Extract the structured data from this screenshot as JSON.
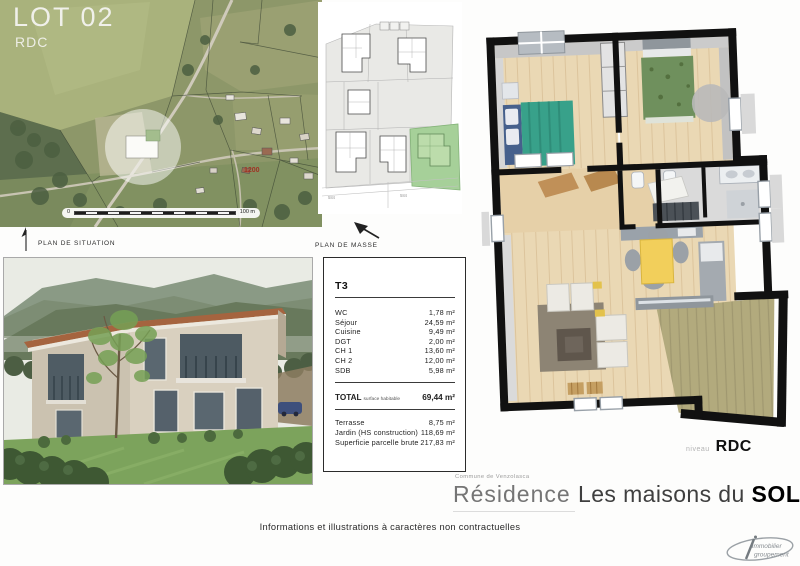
{
  "situation": {
    "lot_label": "LOT 02",
    "level_label": "RDC",
    "parcel_number": "1200",
    "scale_zero": "0",
    "scale_end": "100 m",
    "caption": "PLAN DE SITUATION"
  },
  "masse": {
    "caption": "PLAN DE MASSE",
    "dim_left": "584",
    "dim_right": "584"
  },
  "floorplan": {
    "niveau_label": "niveau",
    "level": "RDC"
  },
  "surface_table": {
    "type_label": "T3",
    "rooms": [
      {
        "label": "WC",
        "area": "1,78 m²"
      },
      {
        "label": "Séjour",
        "area": "24,59 m²"
      },
      {
        "label": "Cuisine",
        "area": "9,49 m²"
      },
      {
        "label": "DGT",
        "area": "2,00 m²"
      },
      {
        "label": "CH 1",
        "area": "13,60 m²"
      },
      {
        "label": "CH 2",
        "area": "12,00 m²"
      },
      {
        "label": "SDB",
        "area": "5,98 m²"
      }
    ],
    "total": {
      "label": "TOTAL",
      "sublabel": "surface habitable",
      "area": "69,44 m²"
    },
    "extras": [
      {
        "label": "Terrasse",
        "area": "8,75 m²"
      },
      {
        "label": "Jardin (HS construction)",
        "area": "118,69 m²"
      },
      {
        "label": "Superficie parcelle brute",
        "area": "217,83 m²"
      }
    ]
  },
  "captions": {
    "commune": "Commune de Venzolasca",
    "residence": "Résidence",
    "name_prefix": "Les maisons du ",
    "name_bold": "SOLEIL"
  },
  "footer": {
    "disclaimer": "Informations et illustrations à caractères non contractuelles"
  },
  "logo": {
    "line1": "immobilier",
    "line2": "groupement"
  },
  "colors": {
    "lot_highlight_green": "#a6d099",
    "floor_wood": "#ead8b4",
    "terrace_khaki": "#b2aa7d",
    "dining_table_yellow": "#f2cf5b",
    "bed_teal": "#38a18a",
    "bed_green": "#6f905d",
    "rug_brown": "#8d8474",
    "parcel_number_red": "#a03224"
  }
}
